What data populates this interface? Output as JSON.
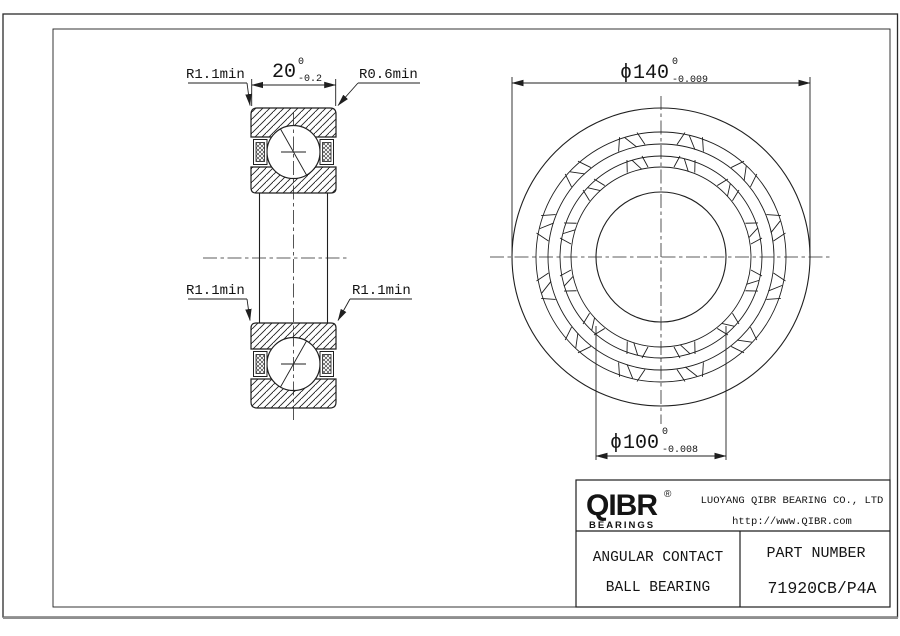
{
  "page": {
    "background": "#ffffff",
    "line_color": "#1f1f1f"
  },
  "section_view": {
    "dim_width": {
      "value": "20",
      "tol_upper": "0",
      "tol_lower": "-0.2"
    },
    "label_top_left": "R1.1min",
    "label_top_right": "R0.6min",
    "label_bottom_left": "R1.1min",
    "label_bottom_right": "R1.1min"
  },
  "front_view": {
    "dim_outer_diameter": {
      "symbol": "ϕ",
      "value": "140",
      "tol_upper": "0",
      "tol_lower": "-0.009"
    },
    "dim_bore_diameter": {
      "symbol": "ϕ",
      "value": "100",
      "tol_upper": "0",
      "tol_lower": "-0.008"
    }
  },
  "title_block": {
    "brand": {
      "logo_text": "QIBR",
      "registered_mark": "®",
      "logo_subtext": "BEARINGS"
    },
    "company_name": "LUOYANG QIBR BEARING CO., LTD",
    "website": "http://www.QIBR.com",
    "product_type_line1": "ANGULAR CONTACT",
    "product_type_line2": "BALL BEARING",
    "part_number_label": "PART NUMBER",
    "part_number": "71920CB/P4A"
  }
}
